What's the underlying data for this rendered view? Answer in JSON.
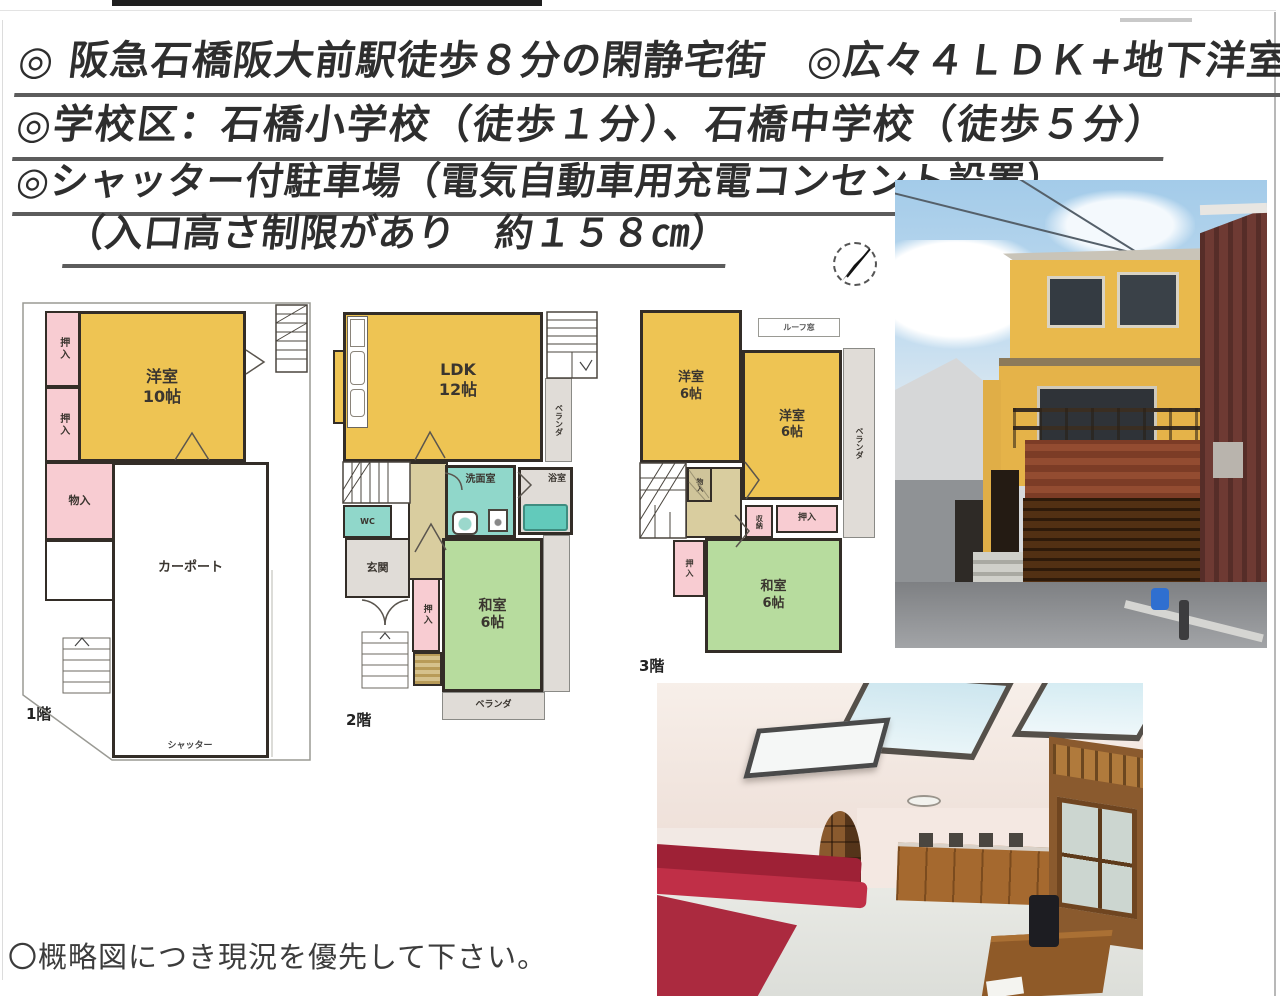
{
  "header": {
    "line1": "◎ 阪急石橋阪大前駅徒歩８分の閑静宅街　◎広々４ＬＤＫ+地下洋室！",
    "line2": "◎学校区：石橋小学校（徒歩１分）、石橋中学校（徒歩５分）",
    "line3": "◎シャッター付駐車場（電気自動車用充電コンセント設置）",
    "line4": "（入口高さ制限があり　約１５８㎝）"
  },
  "note": "〇概略図につき現況を優先して下さい。",
  "plans": {
    "f1": {
      "floor_label": "1階",
      "rooms": {
        "oshiire_a": "押入",
        "oshiire_b": "押入",
        "monoire": "物入",
        "yoshitsu10": "洋室\n10帖",
        "carport": "カーポート",
        "shutter": "シャッター"
      }
    },
    "f2": {
      "floor_label": "2階",
      "rooms": {
        "ldk": "LDK\n12帖",
        "wc": "WC",
        "senmen": "洗面室",
        "bath": "浴室",
        "genkan": "玄関",
        "oshiire": "押入",
        "washitsu": "和室\n6帖",
        "veranda_side": "ベランダ",
        "veranda_bottom": "ベランダ"
      }
    },
    "f3": {
      "floor_label": "3階",
      "rooms": {
        "yoshitsu_a": "洋室\n6帖",
        "yoshitsu_b": "洋室\n6帖",
        "roof_window": "ルーフ窓",
        "veranda": "ベランダ",
        "monoire": "物入",
        "shuno": "収納",
        "oshiire_a": "押入",
        "oshiire_b": "押入",
        "washitsu": "和室\n6帖"
      }
    }
  },
  "colors": {
    "western_room": "#eec453",
    "closet": "#f8ccd2",
    "japanese_room": "#b7dc9e",
    "wet_area": "#90d7ca",
    "hall": "#d9cd9f"
  }
}
